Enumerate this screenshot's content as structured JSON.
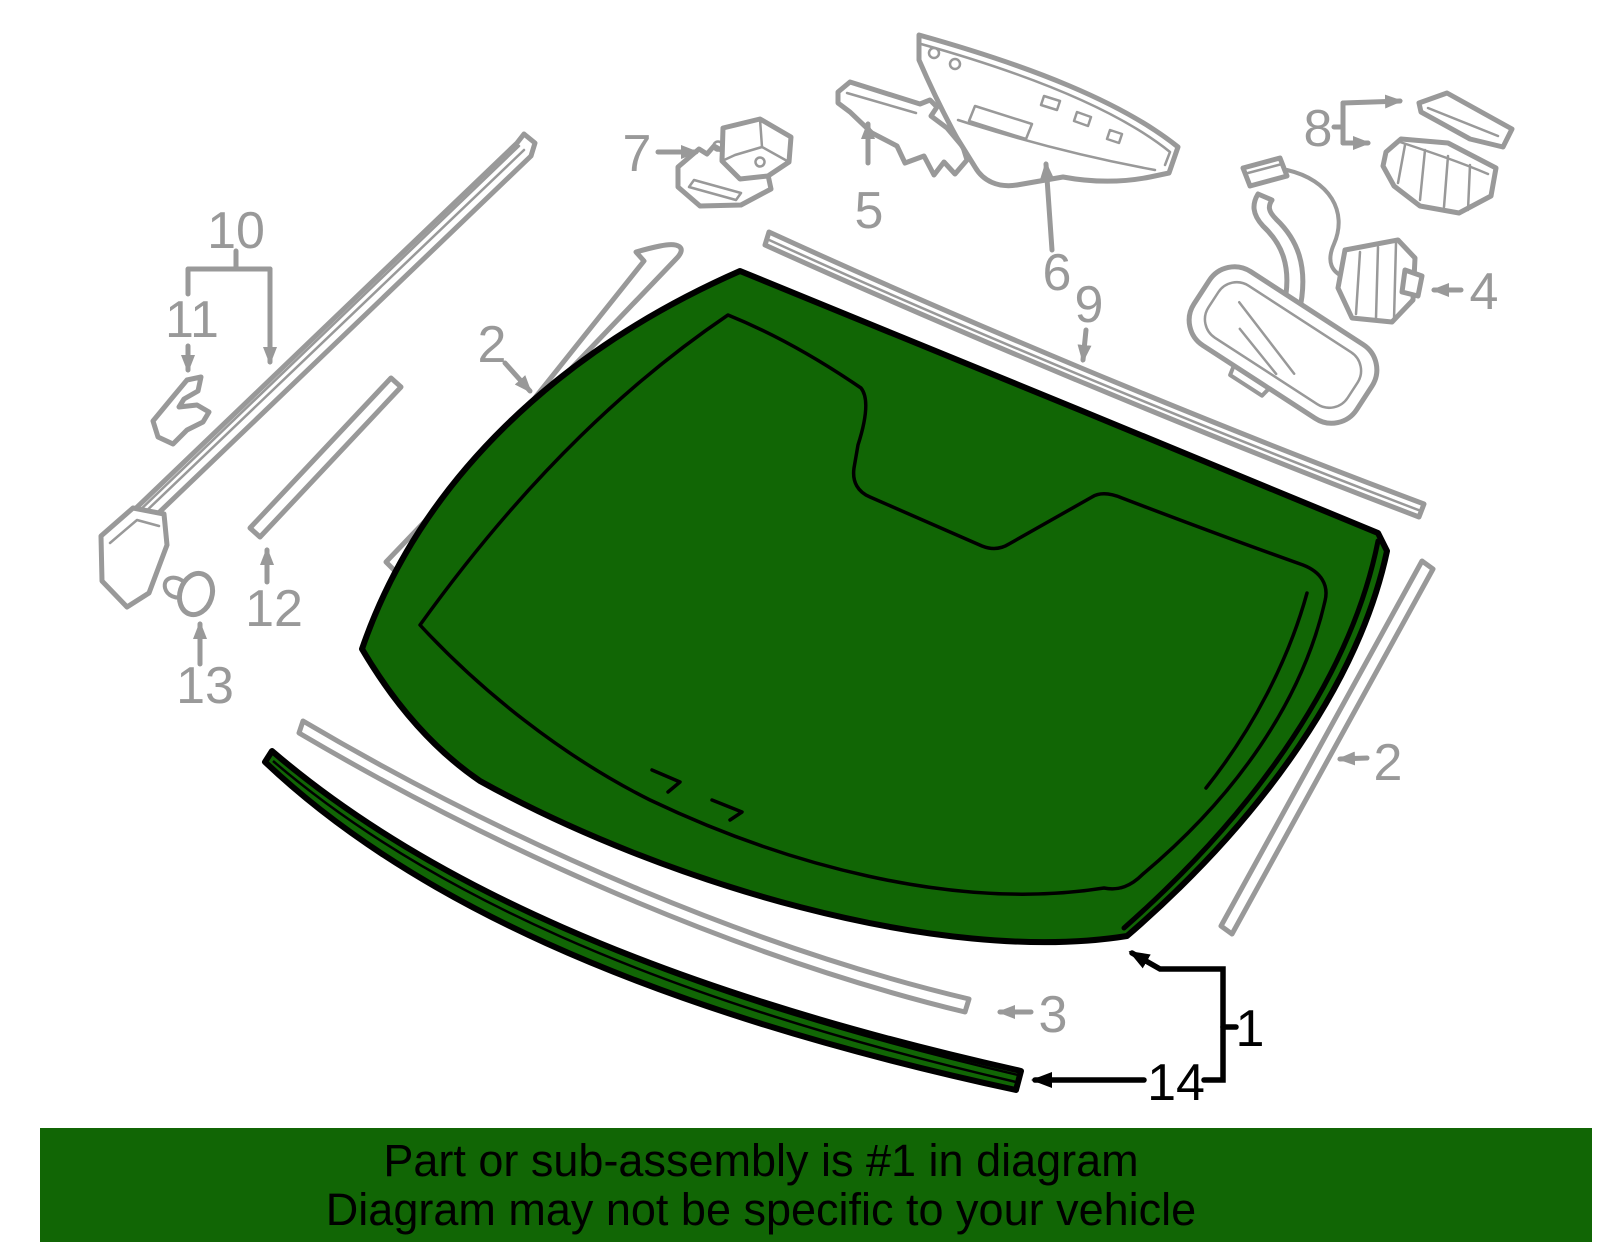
{
  "banner": {
    "line1": "Part or sub-assembly is #1 in diagram",
    "line2": "Diagram may not be specific to your vehicle"
  },
  "highlight": {
    "highlighted_callout": "1"
  },
  "colors": {
    "glass_green": "#116605",
    "banner_green": "#116605",
    "line_gray": "#999999",
    "line_black": "#000000",
    "background": "#ffffff"
  },
  "callouts": {
    "c1": {
      "label": "1"
    },
    "c2_left": {
      "label": "2"
    },
    "c2_right": {
      "label": "2"
    },
    "c3": {
      "label": "3"
    },
    "c4": {
      "label": "4"
    },
    "c5": {
      "label": "5"
    },
    "c6": {
      "label": "6"
    },
    "c7": {
      "label": "7"
    },
    "c8": {
      "label": "8"
    },
    "c9": {
      "label": "9"
    },
    "c10": {
      "label": "10"
    },
    "c11": {
      "label": "11"
    },
    "c12": {
      "label": "12"
    },
    "c13": {
      "label": "13"
    },
    "c14": {
      "label": "14"
    }
  }
}
